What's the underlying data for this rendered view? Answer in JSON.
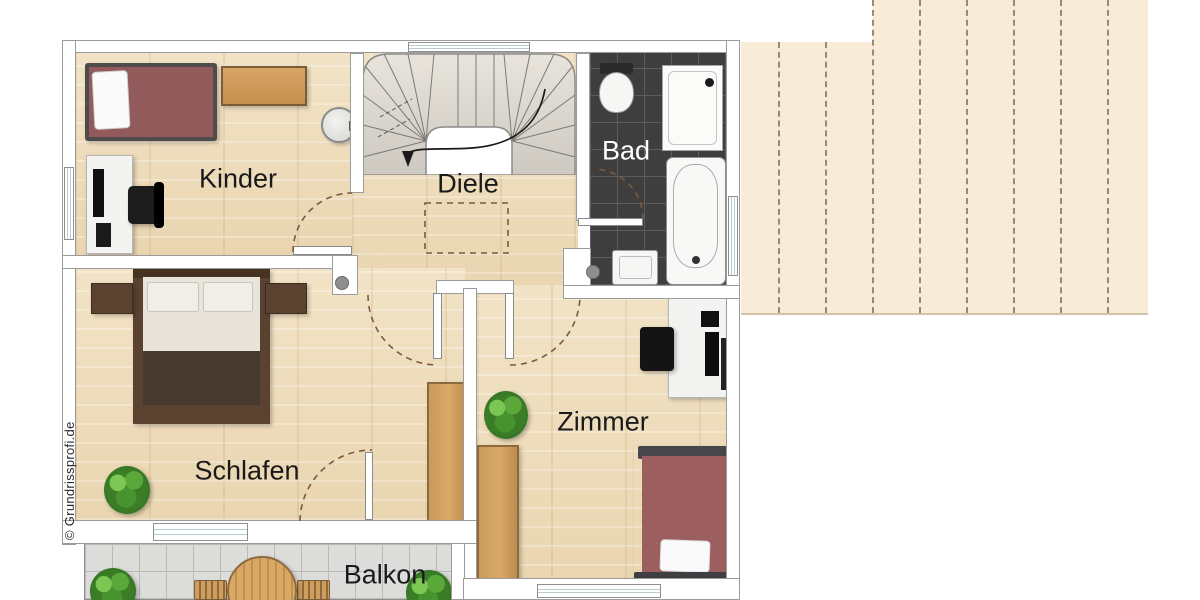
{
  "meta": {
    "type": "floor-plan-upper-storey",
    "watermark": "© Grundrissprofi.de"
  },
  "colors": {
    "floor_wood": "#eedcbc",
    "wall_fill": "#ffffff",
    "wall_outline": "#9b9b9b",
    "bath_tile": "#3e3e3e",
    "balcony_tile": "#dcdcda",
    "roof_area": "#f8ecd9",
    "door_swing_dash": "#7a5a40",
    "bed_mattress": "#9a5c5e",
    "wood_furniture": "#cf9e5f",
    "label_text": "#1a1a1a",
    "bad_label_text": "#ffffff"
  },
  "rooms": [
    {
      "id": "kinder",
      "label": "Kinder",
      "furniture": [
        "single-bed",
        "sideboard",
        "desk",
        "office-chair",
        "washbasin"
      ]
    },
    {
      "id": "diele",
      "label": "Diele",
      "furniture": [
        "staircase",
        "ceiling-opening-dashed"
      ]
    },
    {
      "id": "bad",
      "label": "Bad",
      "furniture": [
        "toilet",
        "shower",
        "bathtub",
        "sink"
      ]
    },
    {
      "id": "schlafen",
      "label": "Schlafen",
      "furniture": [
        "double-bed",
        "nightstand-left",
        "nightstand-right",
        "plant",
        "wardrobe"
      ]
    },
    {
      "id": "zimmer",
      "label": "Zimmer",
      "furniture": [
        "desk",
        "office-chair",
        "plant",
        "wardrobe",
        "single-bed"
      ]
    },
    {
      "id": "balkon",
      "label": "Balkon",
      "furniture": [
        "round-table",
        "chair-left",
        "chair-right",
        "plant-left",
        "plant-right"
      ]
    }
  ],
  "roof": {
    "dash_line_count": 8,
    "description": "roof-surface-with-dashed-slope-lines"
  }
}
